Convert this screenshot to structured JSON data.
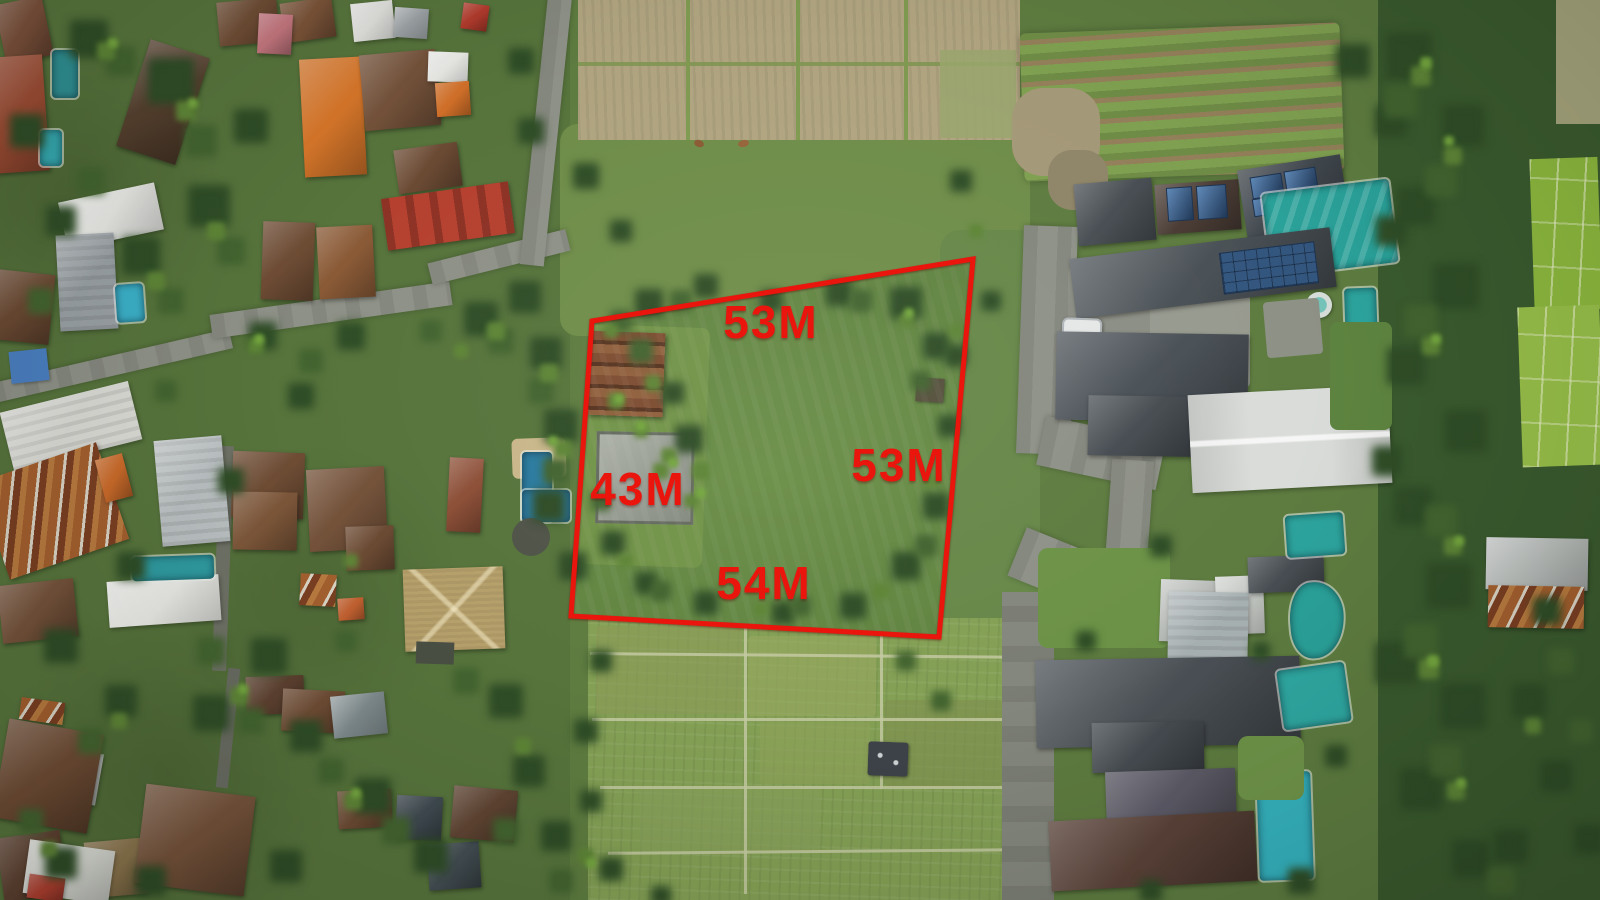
{
  "image_type": "aerial-drone-photo",
  "annotation": {
    "shape": "land-boundary-quadrilateral",
    "color": "#ea150d",
    "polygon_points": "592,321 973,259 939,637 571,616",
    "labels": {
      "top": "53M",
      "right": "53M",
      "left": "43M",
      "bottom": "54M"
    }
  },
  "scene": {
    "land_plot": "grass field with wooden shed and concrete pad outlined in red",
    "west": "village houses with clay, metal and thatch roofs, small pools",
    "east": "villa complex with slate roofs, solar panels and swimming pools",
    "north": "dry rice paddies with two cows",
    "south": "green rice paddy terraces with small hut",
    "palette": {
      "grass": "#5d7f42",
      "forest": "#2f4d27",
      "paddy_dry": "#b0a480",
      "paddy_green": "#84a055",
      "pool_teal": "#2aa29a",
      "pool_blue": "#2b7a9e",
      "roof_orange": "#d6762a",
      "roof_terracotta": "#9b4c33",
      "roof_slate": "#474d52",
      "road": "#8e9187"
    }
  }
}
